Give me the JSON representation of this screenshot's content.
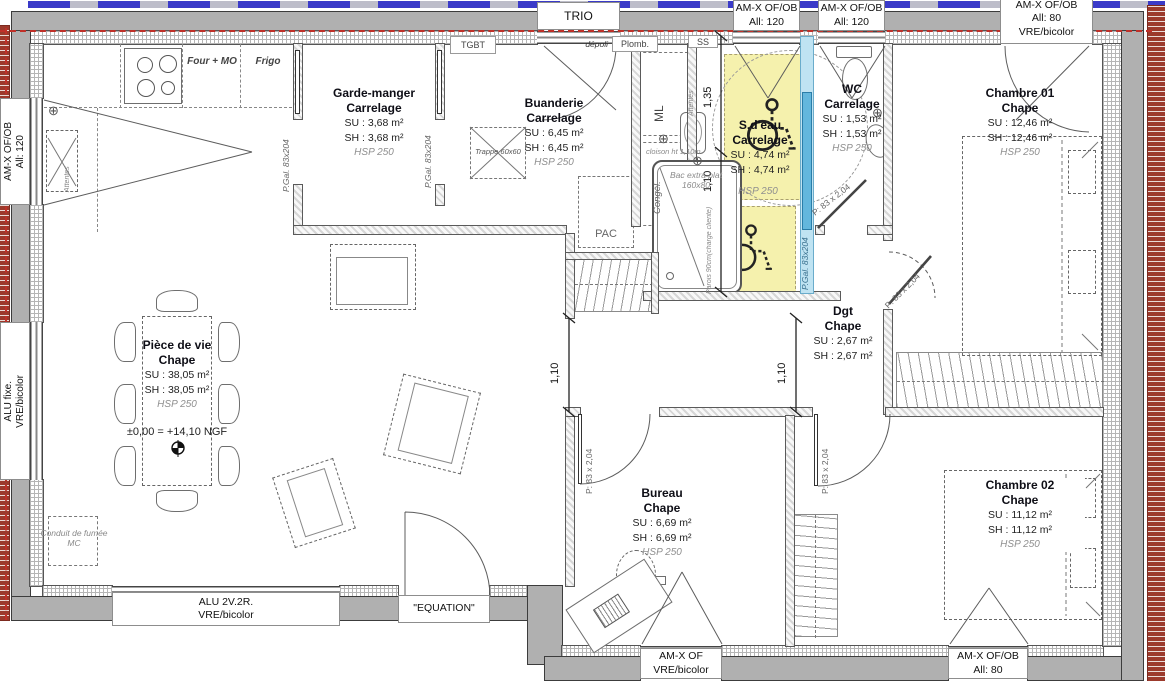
{
  "plan": {
    "rooms": {
      "piece_de_vie": {
        "name": "Pièce de vie",
        "finish": "Chape",
        "su": "SU : 38,05 m²",
        "sh": "SH : 38,05 m²",
        "hsp": "HSP 250",
        "level": "±0,00 = +14,10 NGF"
      },
      "garde_manger": {
        "name": "Garde-manger",
        "finish": "Carrelage",
        "su": "SU : 3,68 m²",
        "sh": "SH : 3,68 m²",
        "hsp": "HSP 250"
      },
      "buanderie": {
        "name": "Buanderie",
        "finish": "Carrelage",
        "su": "SU : 6,45 m²",
        "sh": "SH : 6,45 m²",
        "hsp": "HSP 250"
      },
      "sdeau": {
        "name": "S.d'eau",
        "finish": "Carrelage",
        "su": "SU : 4,74 m²",
        "sh": "SH : 4,74 m²"
      },
      "wc": {
        "name": "WC",
        "finish": "Carrelage",
        "su": "SU : 1,53 m²",
        "sh": "SH : 1,53 m²",
        "hsp": "HSP 250"
      },
      "chambre01": {
        "name": "Chambre 01",
        "finish": "Chape",
        "su": "SU : 12,46 m²",
        "sh": "SH : 12,46 m²",
        "hsp": "HSP 250"
      },
      "dgt": {
        "name": "Dgt",
        "finish": "Chape",
        "su": "SU : 2,67 m²",
        "sh": "SH : 2,67 m²"
      },
      "bureau": {
        "name": "Bureau",
        "finish": "Chape",
        "su": "SU : 6,69 m²",
        "sh": "SH : 6,69 m²",
        "hsp": "HSP 250"
      },
      "chambre02": {
        "name": "Chambre 02",
        "finish": "Chape",
        "su": "SU : 11,12 m²",
        "sh": "SH : 11,12 m²",
        "hsp": "HSP 250"
      }
    },
    "windows": {
      "trio": {
        "label": "TRIO",
        "note": "dépoli"
      },
      "top_window_1": {
        "line1": "AM-X OF/OB",
        "line2": "All:  120"
      },
      "top_window_2": {
        "line1": "AM-X OF/OB",
        "line2": "All:  120"
      },
      "top_window_3": {
        "line1": "AM-X OF/OB",
        "line2": "All:  80",
        "line3": "VRE/bicolor"
      },
      "left_window_1": {
        "line1": "AM-X OF/OB",
        "line2": "All:  120"
      },
      "left_window_2": {
        "line1": "ALU fixe.",
        "line2": "VRE/bicolor"
      },
      "bottom_window_1": {
        "line1": "ALU 2V.2R.",
        "line2": "VRE/bicolor"
      },
      "entry_door": {
        "label": "\"EQUATION\""
      },
      "bottom_window_2": {
        "line1": "AM-X OF",
        "line2": "VRE/bicolor"
      },
      "bottom_window_3": {
        "line1": "AM-X OF/OB",
        "line2": "All:  80"
      }
    },
    "doors": {
      "garde_manger": "P.Gal. 83x204",
      "buanderie": "P.Gal. 83x204",
      "sdeau": "P.Gal. 83x204",
      "wc": "P: 83 x 2,04",
      "chambre01": "P: 83 x 2,04",
      "chambre02": "P: 83 x 2,04",
      "bureau": "P: 83 x 2,04"
    },
    "kitchen": {
      "four": "Four + MO",
      "frigo": "Frigo"
    },
    "equipment": {
      "tgbt": "TGBT",
      "plomb": "Plomb.",
      "ss": "SS",
      "ml": "ML",
      "congel": "Congél.",
      "pac": "PAC",
      "trappe": "Trappe 60x60",
      "shower_line1": "Bac extra plat",
      "shower_line2": "160x80",
      "cloison": "cloison ht 1,10m",
      "parois": "Parois 90cm(charge cliente)",
      "attentes": "Attentes",
      "conduit_line1": "Conduit de fumée",
      "conduit_line2": "MC",
      "hsp_zone": "HSP 250"
    },
    "dimensions": {
      "d135": "1,35",
      "d110_hall": "1,10",
      "d110_living": "1,10",
      "d110_dgt": "1,10"
    },
    "icons": {
      "position_cross": "⊕"
    },
    "colors": {
      "accessible_zone": "#f5f1ad",
      "sliding_door": "#63b7dd",
      "boundary_red": "#c03028",
      "boundary_blue": "#3a3ac8"
    }
  }
}
